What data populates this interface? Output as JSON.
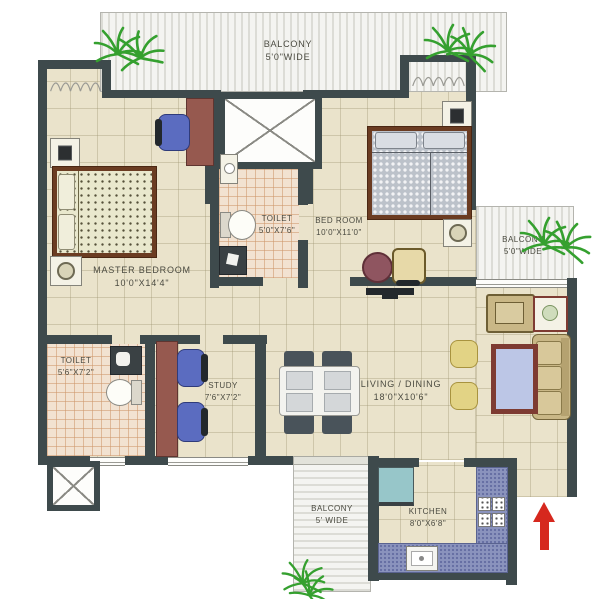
{
  "rooms": {
    "balcony_top": {
      "name": "BALCONY",
      "size": "5'0\"WIDE"
    },
    "balcony_right": {
      "name": "BALCONY",
      "size": "5'0\"WIDE"
    },
    "balcony_bottom": {
      "name": "BALCONY",
      "size": "5' WIDE"
    },
    "master_bedroom": {
      "name": "MASTER BEDROOM",
      "size": "10'0\"X14'4\""
    },
    "toilet_1": {
      "name": "TOILET",
      "size": "5'0\"X7'6\""
    },
    "bedroom": {
      "name": "BED ROOM",
      "size": "10'0\"X11'0\""
    },
    "toilet_2": {
      "name": "TOILET",
      "size": "5'6\"X7'2\""
    },
    "study": {
      "name": "STUDY",
      "size": "7'6\"X7'2\""
    },
    "living_dining": {
      "name": "LIVING / DINING",
      "size": "18'0\"X10'6\""
    },
    "kitchen": {
      "name": "KITCHEN",
      "size": "8'0\"X6'8\""
    }
  },
  "icons": {
    "entry_arrow": "red up-arrow marking entrance",
    "plant": "green plant burst",
    "shaft": "crossed duct/shaft box"
  },
  "colors": {
    "wall": "#3e4a4c",
    "floor": "#eae3cb",
    "tile": "#f2e2d1",
    "counter_blue": "#8a93bd",
    "sofa_tan": "#c9b786",
    "accent_red": "#d6281e",
    "plant_green": "#35a02f"
  }
}
